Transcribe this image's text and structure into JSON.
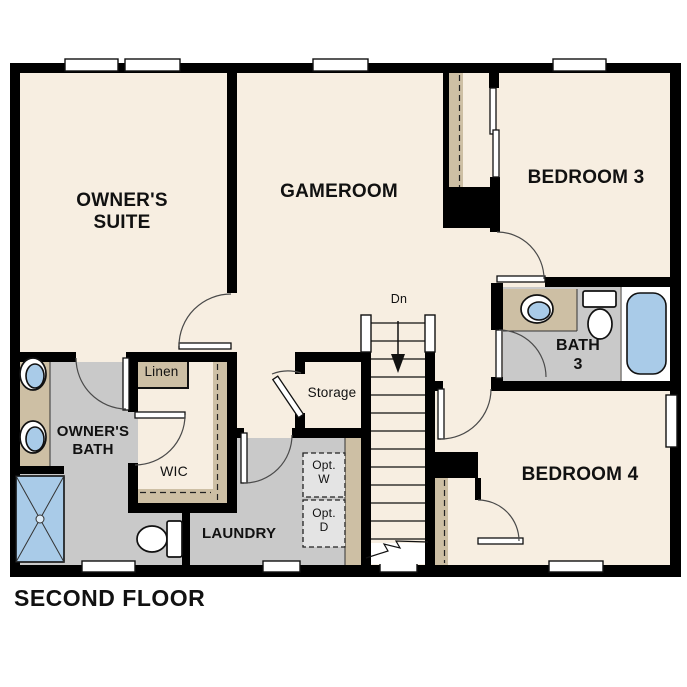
{
  "title": "SECOND FLOOR",
  "rooms": {
    "owners_suite": "OWNER'S SUITE",
    "gameroom": "GAMEROOM",
    "bedroom3": "BEDROOM 3",
    "bedroom4": "BEDROOM 4",
    "bath3": "BATH 3",
    "owners_bath": "OWNER'S BATH",
    "wic": "WIC",
    "laundry": "LAUNDRY",
    "storage": "Storage",
    "linen": "Linen"
  },
  "annotations": {
    "stairs_direction": "Dn",
    "optional_washer": "Opt. W",
    "optional_dryer": "Opt. D"
  },
  "colors": {
    "floor": "#f7eee1",
    "tile_gray": "#c9c9c9",
    "casework_tan": "#cdbfa4",
    "fixture_blue": "#a9cbe8",
    "wall": "#000000",
    "optional_fill": "#e4e4e4",
    "label_ink": "#111111"
  }
}
